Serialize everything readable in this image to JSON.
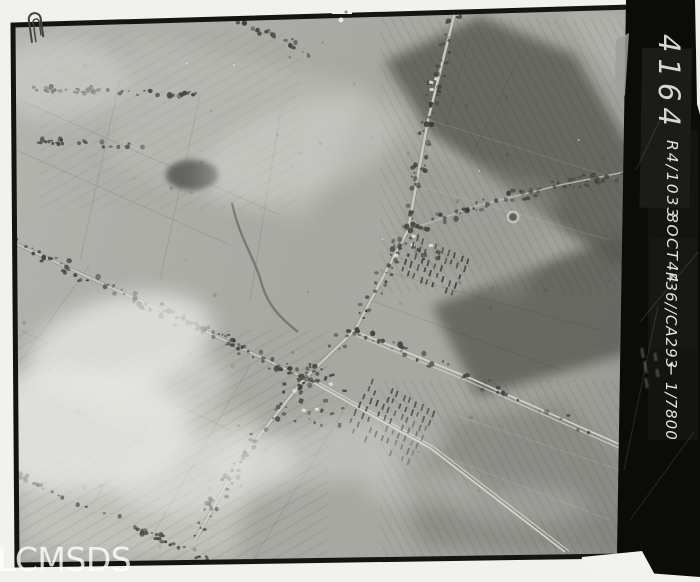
{
  "photo_print": {
    "print_number": "4164",
    "annotation": {
      "sortie": "R4/1033",
      "date": "8OCT44",
      "camera": "F36//CA293",
      "arrow": "←",
      "scale": "1/7800",
      "full_text": "R4/1033 8OCT44 F36//CA293 ← 1/7800"
    },
    "watermark": "LCMSDS"
  },
  "colors": {
    "paper": "#f1f1ee",
    "strip_black": "#0b0b09",
    "strip_text": "#e3e3dd",
    "photo_base": "#a4a49e",
    "watermark": "#ffffff"
  }
}
